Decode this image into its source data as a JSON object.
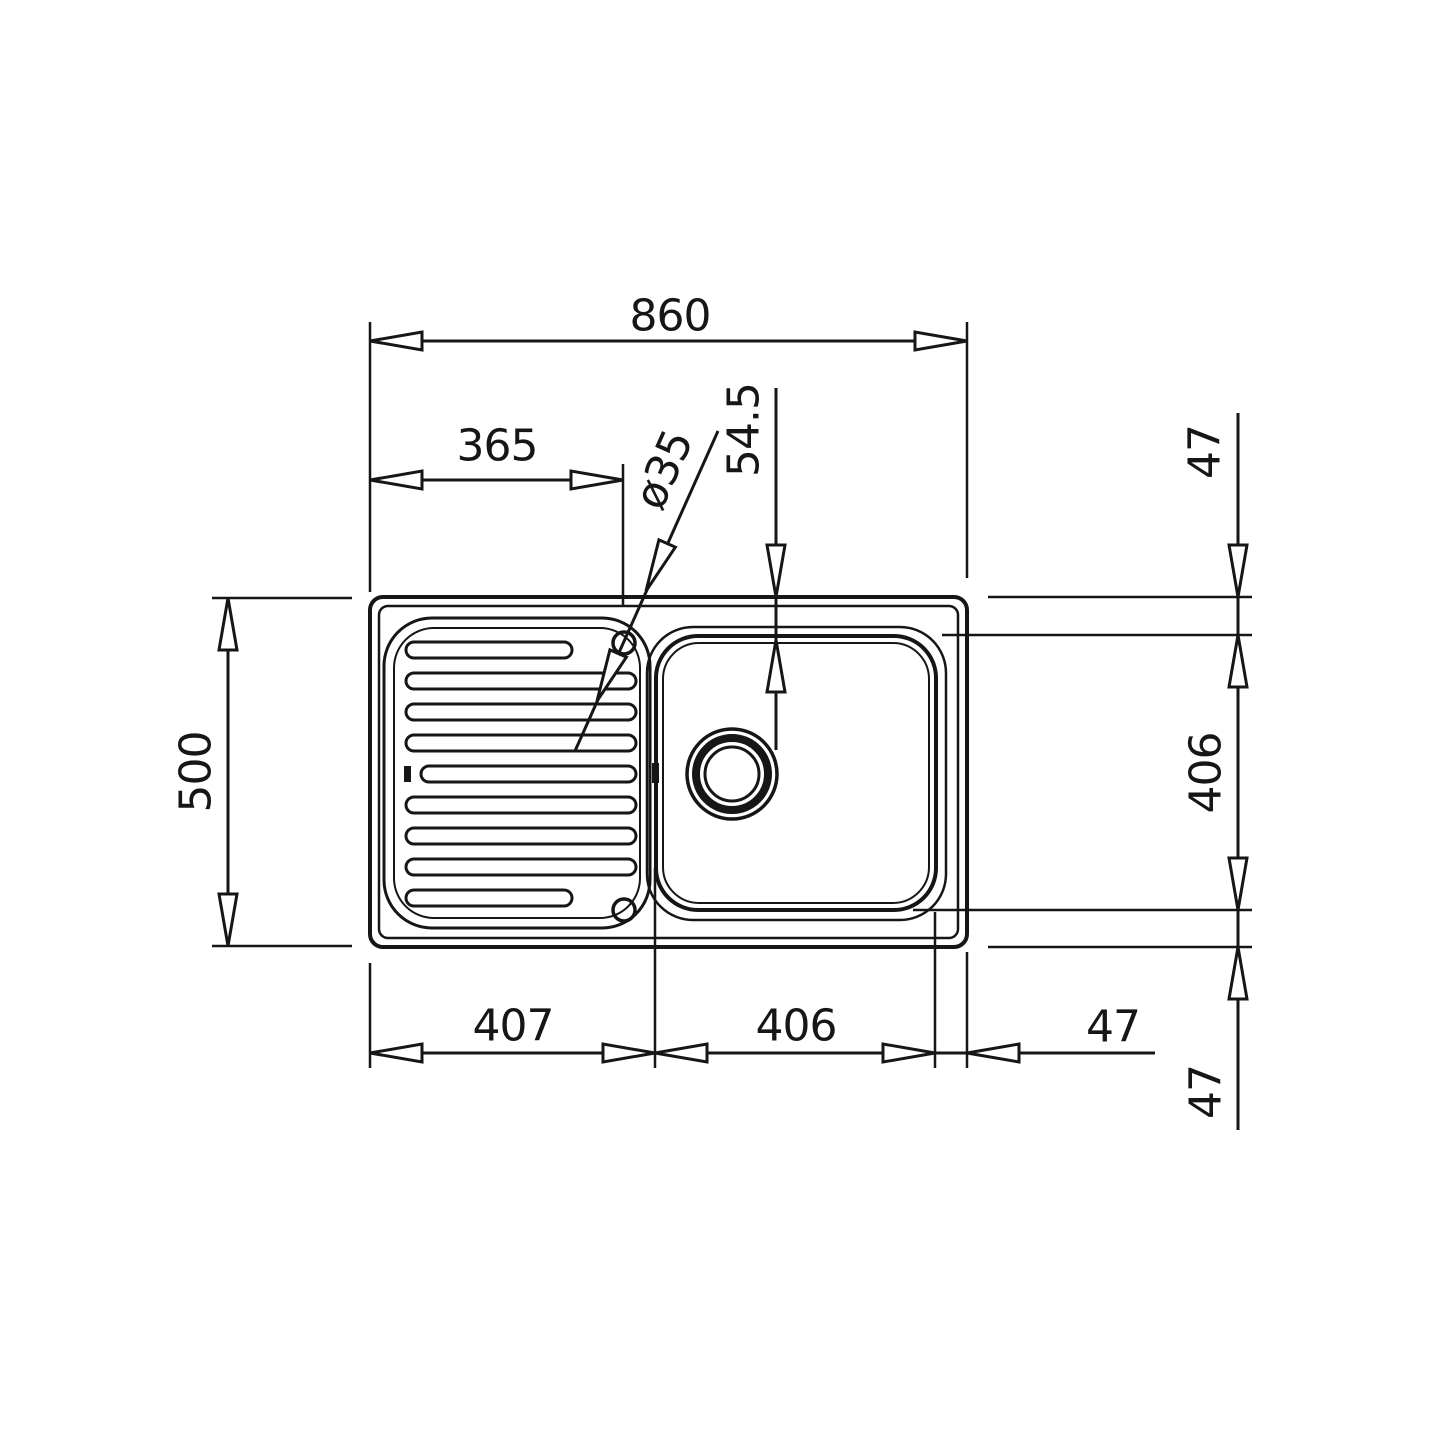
{
  "drawing": {
    "title": "Inset sink with drainer - dimensioned top view",
    "type": "technical dimension drawing"
  },
  "colors": {
    "line": "#161616",
    "text": "#161616",
    "background": "#ffffff"
  },
  "dimensions": {
    "overall_width": "860",
    "drainer_width": "365",
    "tap_hole_diameter": "ø35",
    "rim_to_bowl": "54.5",
    "overall_depth": "500",
    "drainer_section_width": "407",
    "bowl_width": "406",
    "bowl_to_edge_right": "47",
    "rim_to_bowl_top_right": "47",
    "bowl_depth": "406",
    "rim_to_bowl_bottom_right": "47"
  }
}
